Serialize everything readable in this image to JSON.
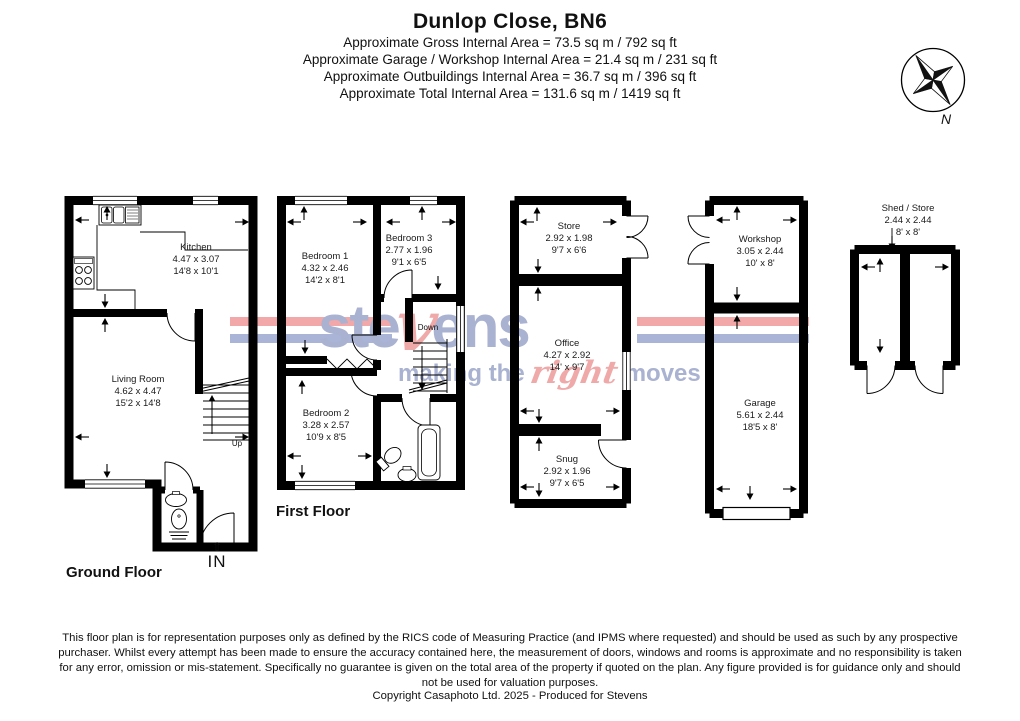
{
  "header": {
    "title": "Dunlop Close, BN6",
    "area_lines": [
      "Approximate Gross Internal Area = 73.5 sq m / 792 sq ft",
      "Approximate Garage / Workshop Internal Area = 21.4 sq m / 231 sq ft",
      "Approximate Outbuildings Internal Area = 36.7 sq m / 396 sq ft",
      "Approximate Total Internal Area = 131.6 sq m / 1419 sq ft"
    ]
  },
  "compass": {
    "north_label": "N"
  },
  "floors": {
    "ground": {
      "label": "Ground Floor",
      "entrance_label": "IN",
      "entrance_arrow": "⇧",
      "stairs_label": "Up",
      "rooms": {
        "kitchen": {
          "name": "Kitchen",
          "metric": "4.47 x 3.07",
          "imperial": "14'8 x 10'1"
        },
        "living_room": {
          "name": "Living Room",
          "metric": "4.62 x 4.47",
          "imperial": "15'2 x 14'8"
        }
      }
    },
    "first": {
      "label": "First Floor",
      "stairs_label": "Down",
      "rooms": {
        "bedroom1": {
          "name": "Bedroom 1",
          "metric": "4.32 x 2.46",
          "imperial": "14'2 x 8'1"
        },
        "bedroom2": {
          "name": "Bedroom 2",
          "metric": "3.28 x 2.57",
          "imperial": "10'9 x 8'5"
        },
        "bedroom3": {
          "name": "Bedroom 3",
          "metric": "2.77 x 1.96",
          "imperial": "9'1 x 6'5"
        }
      }
    },
    "outbuilding1": {
      "rooms": {
        "store": {
          "name": "Store",
          "metric": "2.92 x 1.98",
          "imperial": "9'7 x 6'6"
        },
        "office": {
          "name": "Office",
          "metric": "4.27 x 2.92",
          "imperial": "14' x 9'7"
        },
        "snug": {
          "name": "Snug",
          "metric": "2.92 x 1.96",
          "imperial": "9'7 x 6'5"
        }
      }
    },
    "outbuilding2": {
      "rooms": {
        "workshop": {
          "name": "Workshop",
          "metric": "3.05 x 2.44",
          "imperial": "10' x 8'"
        },
        "garage": {
          "name": "Garage",
          "metric": "5.61 x 2.44",
          "imperial": "18'5 x 8'"
        }
      }
    },
    "shed": {
      "rooms": {
        "shed_store": {
          "name": "Shed / Store",
          "metric": "2.44 x 2.44",
          "imperial": "8' x 8'"
        }
      }
    }
  },
  "watermark": {
    "brand_pre": "ste",
    "brand_v": "v",
    "brand_post": "ens",
    "tagline_pre": "making the",
    "tagline_accent": "right",
    "tagline_post": "moves",
    "colors": {
      "brand_blue": "#a9b2d0",
      "brand_red": "#efa9a9",
      "bar_red": "#f2a8a8",
      "bar_blue": "#aab4d7"
    }
  },
  "footer": {
    "disclaimer": "This floor plan is for representation purposes only as defined by the RICS code of Measuring Practice (and IPMS where requested) and should be used as such by any prospective purchaser. Whilst every attempt has been made to ensure the accuracy contained here, the measurement of doors, windows and rooms is approximate and no responsibility is taken for any error, omission or mis-statement. Specifically no guarantee is given on the total area of the property if quoted on the plan. Any figure provided is for guidance only and should not be used for valuation purposes.",
    "copyright": "Copyright Casaphoto Ltd. 2025 - Produced for Stevens"
  }
}
